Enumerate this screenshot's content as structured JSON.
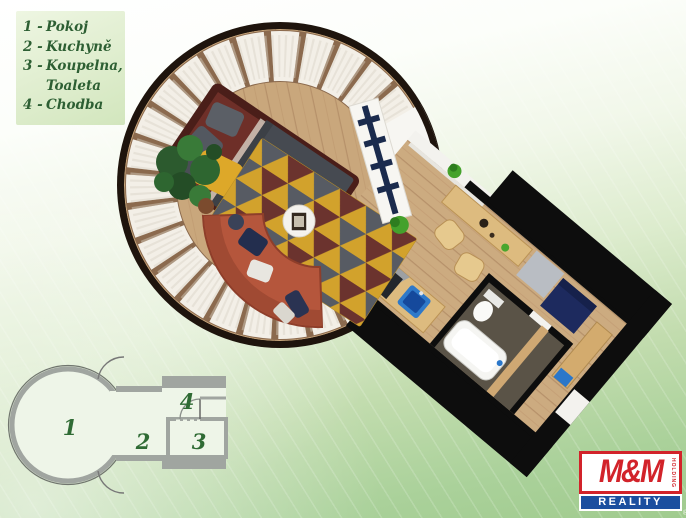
{
  "legend": {
    "items": [
      {
        "prefix": "1 -",
        "name": "Pokoj"
      },
      {
        "prefix": "2 -",
        "name": "Kuchyně"
      },
      {
        "prefix": "3 -",
        "name": "Koupelna, Toaleta"
      },
      {
        "prefix": "4 -",
        "name": "Chodba"
      }
    ]
  },
  "mini_plan": {
    "labels": {
      "room1": "1",
      "room2": "2",
      "room3": "3",
      "room4": "4"
    }
  },
  "plan3d": {
    "furniture_icons": [
      "bed-icon",
      "curved-sofa-icon",
      "area-rug-icon",
      "coffee-table-icon",
      "plant-icon",
      "ladder-bench-icon",
      "bar-counter-icon",
      "bar-stool-icon",
      "kitchen-counter-icon",
      "stove-icon",
      "sink-icon",
      "washer-icon",
      "daybed-icon",
      "toilet-icon",
      "bathtub-icon",
      "hall-cabinet-icon"
    ]
  },
  "logo": {
    "brand": "M&M",
    "holding": "HOLDING",
    "reality": "REALITY",
    "registered": "®"
  },
  "colors": {
    "background_green": "#a0cb8e",
    "legend_panel": "#e2efd2",
    "legend_text": "#2d5f33",
    "wood_floor": "#c9a77c",
    "wall_black": "#0d0d0d",
    "rug_yellow": "#d2a22c",
    "rug_gray": "#575b63",
    "rug_maroon": "#6b332e",
    "sofa_terracotta": "#b5563c",
    "bed_frame": "#4a1e19",
    "accent_navy": "#1d2a5e",
    "sink_blue": "#2e79c9",
    "mini_plan_wall": "#a0a5a0",
    "logo_red": "#d2232a",
    "logo_blue": "#1b4f9f"
  }
}
